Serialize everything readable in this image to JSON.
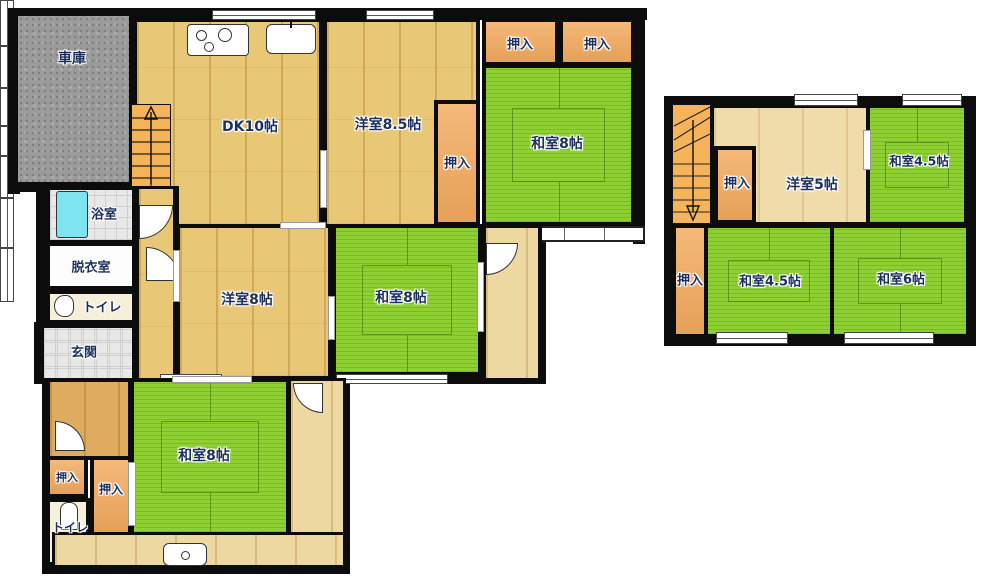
{
  "plan_title": "2-story house floor plan",
  "colors": {
    "tatami_green": "#8ED032",
    "wood_floor": "#E8C777",
    "wood_light": "#EED8A2",
    "closet_orange": "#F2A95C",
    "stairs_orange": "#F5B459",
    "wall_black": "#0C0C0C",
    "bathtub_cyan": "#7EE4EF",
    "garage_gray": "#9B9B9B",
    "label_text": "#1C2F5E"
  },
  "floor1": {
    "garage": "車庫",
    "dk": "DK10帖",
    "western85": "洋室8.5帖",
    "closet": "押入",
    "japanese8_ne": "和室8帖",
    "bath": "浴室",
    "dressing": "脱衣室",
    "toilet": "トイレ",
    "entrance": "玄関",
    "western8": "洋室8帖",
    "japanese8_mid": "和室8帖",
    "japanese8_s": "和室8帖",
    "toilet2": "トイレ"
  },
  "floor2": {
    "closet": "押入",
    "western5": "洋室5帖",
    "japanese45_ne": "和室4.5帖",
    "japanese45_s": "和室4.5帖",
    "japanese6": "和室6帖"
  }
}
